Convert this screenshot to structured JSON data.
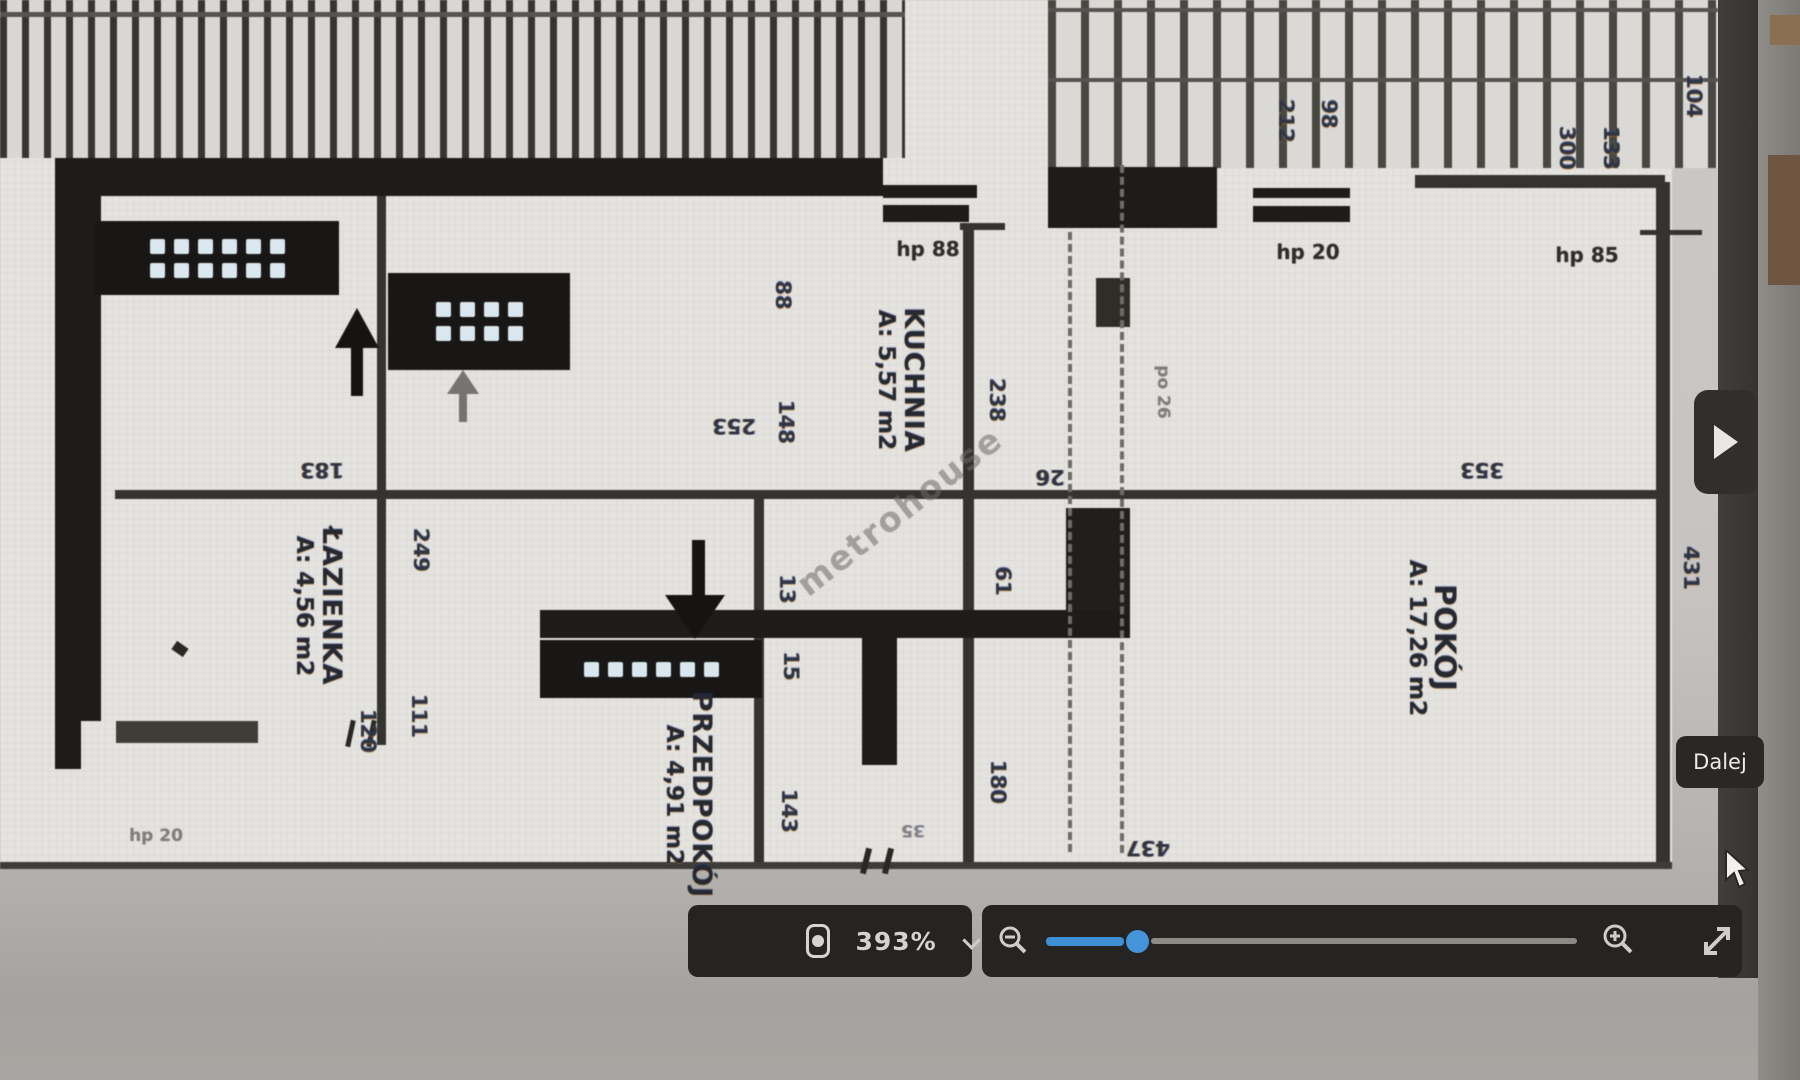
{
  "viewer": {
    "next_tooltip": "Dalej",
    "toolbar": {
      "zoom_level": "393%",
      "camera_icon": "camera-icon",
      "chevron_icon": "chevron-down-icon",
      "zoom_out_icon": "magnifier-minus",
      "zoom_in_icon": "magnifier-plus",
      "fullscreen_icon": "diagonal-expand-arrows",
      "accent_color": "#3f8fd6",
      "bar_color": "#262422"
    }
  },
  "plan": {
    "watermark": "metrohouse",
    "rooms": [
      {
        "name": "KUCHNIA",
        "area": "A: 5,57 m2"
      },
      {
        "name": "ŁAZIENKA",
        "area": "A: 4,56 m2"
      },
      {
        "name": "PRZEDPOKÓJ",
        "area": "A: 4,91 m2"
      },
      {
        "name": "POKÓJ",
        "area": "A: 17,26 m2"
      }
    ],
    "dims_v": [
      "88",
      "148",
      "238",
      "249",
      "111",
      "13",
      "15",
      "143",
      "180",
      "61",
      "120",
      "212",
      "98",
      "104",
      "300",
      "133",
      "431"
    ],
    "dims_h": [
      "353",
      "183",
      "253",
      "26",
      "437",
      "35"
    ],
    "annotations": {
      "hp_top_left": "hp 88",
      "hp_top_mid": "hp 20",
      "hp_top_right": "hp 85",
      "hp_bottom_left": "hp 20",
      "pencil_note": "po 26"
    }
  }
}
